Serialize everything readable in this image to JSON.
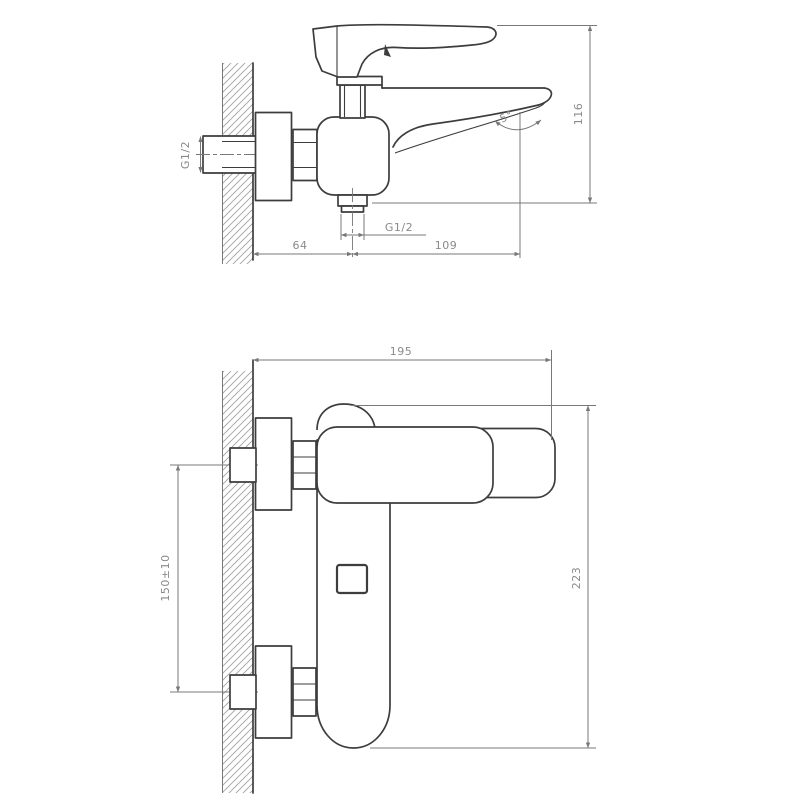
{
  "colors": {
    "background": "#ffffff",
    "line_color": "#3d3d3d",
    "dim_color": "#787878",
    "text_color": "#8a8a8a",
    "hatch_color": "#a2a2a2"
  },
  "side_view": {
    "dim_inlet_thread": "G1/2",
    "dim_wall_to_outlet": "64",
    "dim_outlet_to_spout_tip": "109",
    "dim_outlet_thread": "G1/2",
    "dim_height": "116",
    "dim_spout_angle": "5°"
  },
  "front_view": {
    "dim_width": "195",
    "dim_inlet_spacing": "150±10",
    "dim_height": "223"
  }
}
